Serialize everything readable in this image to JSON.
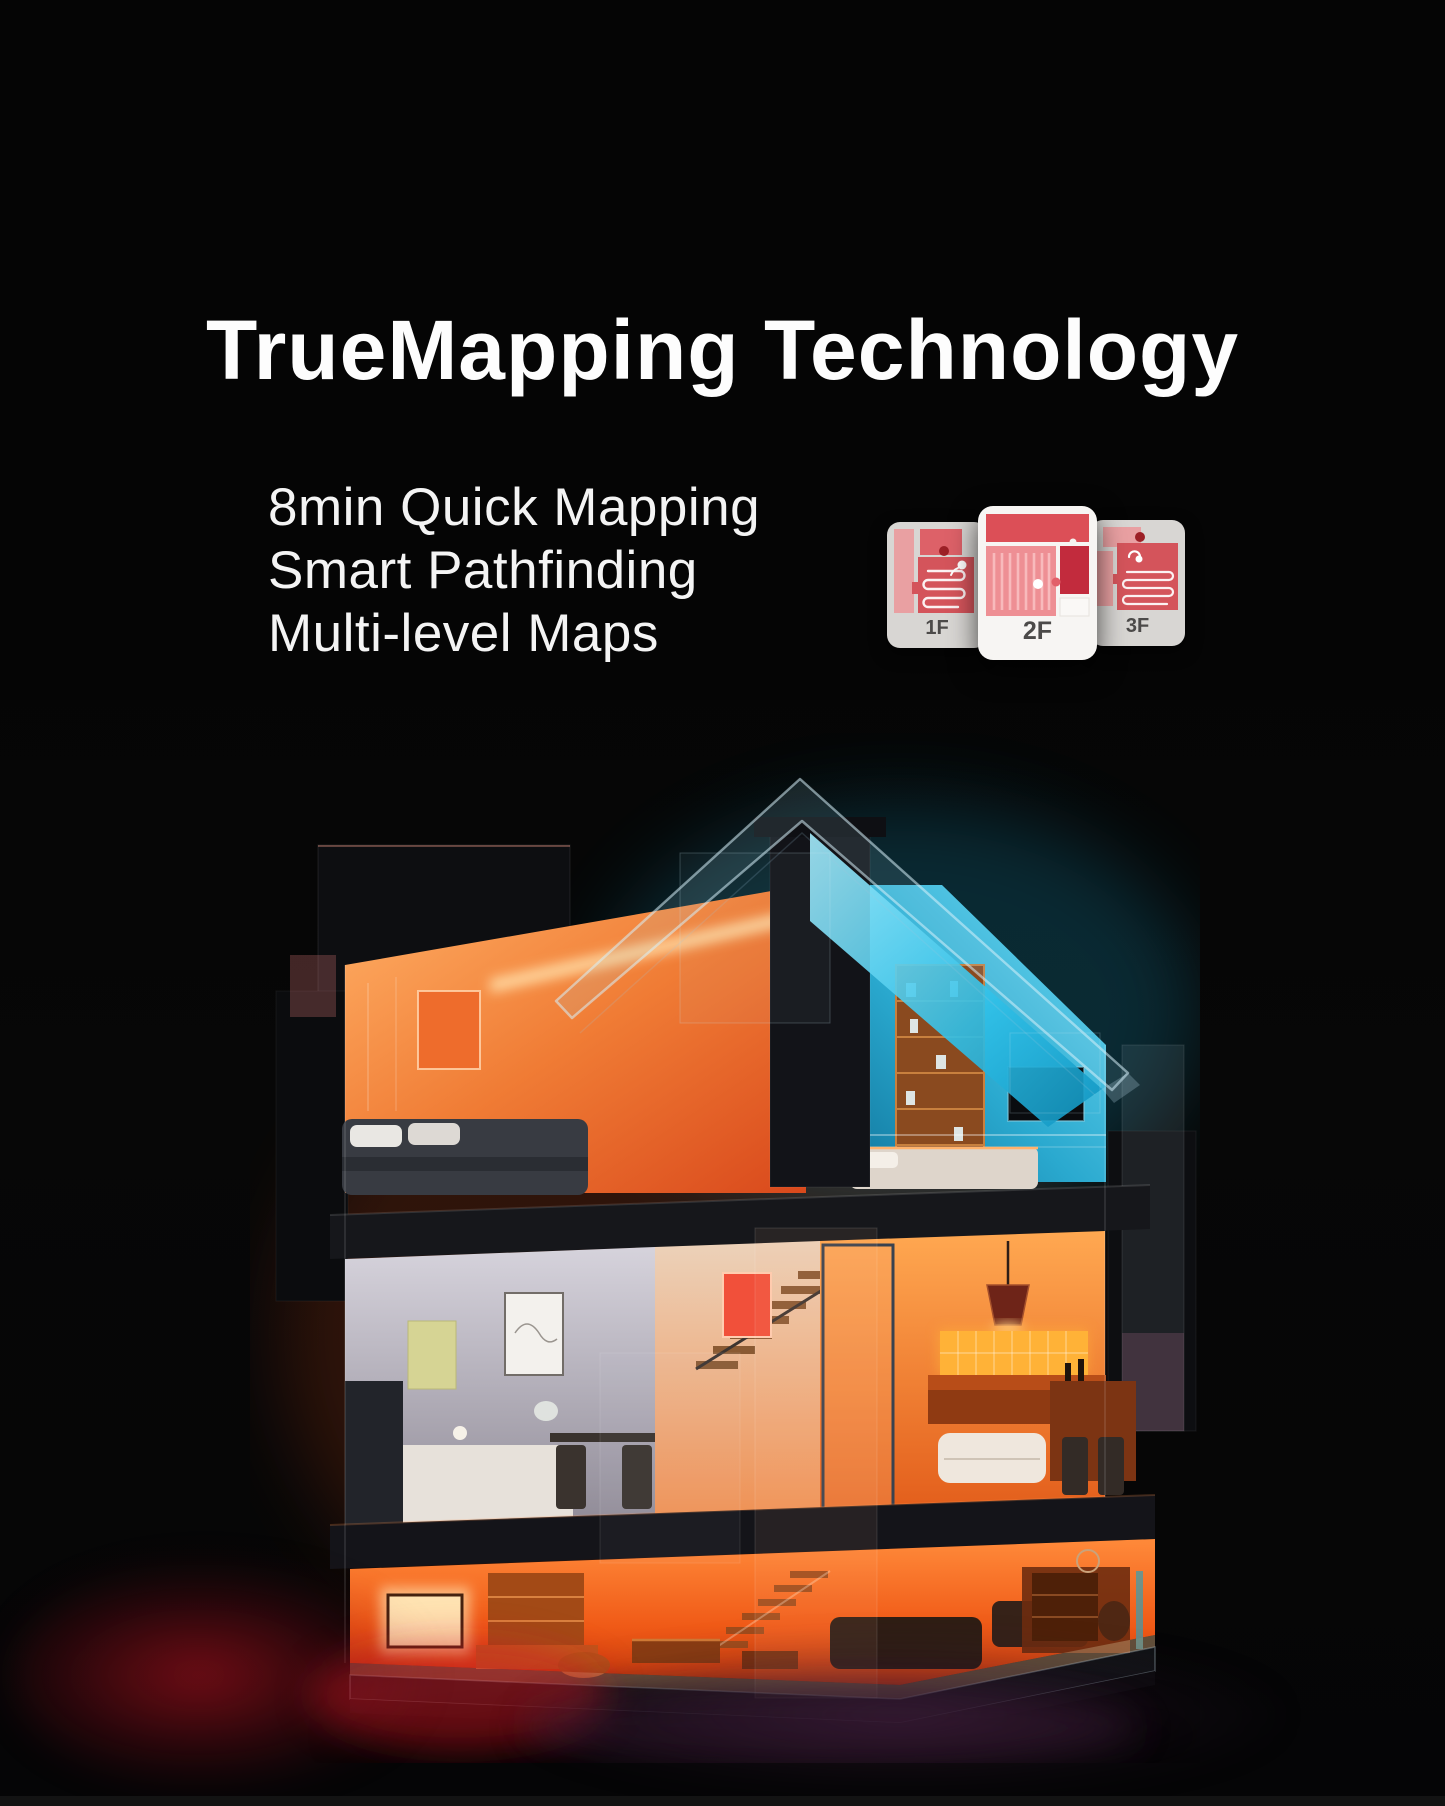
{
  "page": {
    "background_color": "#050505",
    "bottom_strip_color": "#131313"
  },
  "header": {
    "title": "TrueMapping Technology",
    "title_color": "#ffffff"
  },
  "features": {
    "text_color": "#f4f4f4",
    "items": [
      "8min Quick Mapping",
      "Smart Pathfinding",
      "Multi-level Maps"
    ]
  },
  "floor_maps": {
    "cards": [
      {
        "label": "1F",
        "highlighted": false
      },
      {
        "label": "2F",
        "highlighted": true
      },
      {
        "label": "3F",
        "highlighted": false
      }
    ],
    "label_color": "#4c4a49",
    "front_card_bg": "#f7f5f3",
    "side_card_bg": "#d8d6d3",
    "map_colors": {
      "room_red": "#d4545b",
      "room_pink": "#ee8f94",
      "room_dark_red": "#c22b3d",
      "room_light_pink": "#e9a0a2",
      "dock_dot": "#9c2026",
      "robot_path": "#ffffff"
    }
  },
  "illustration": {
    "name": "three-story-smart-home-cutaway",
    "accent_colors": {
      "roof_cyan": "#2bbfe4",
      "interior_orange": "#ff7a2e",
      "ember_red": "#c81622"
    }
  }
}
